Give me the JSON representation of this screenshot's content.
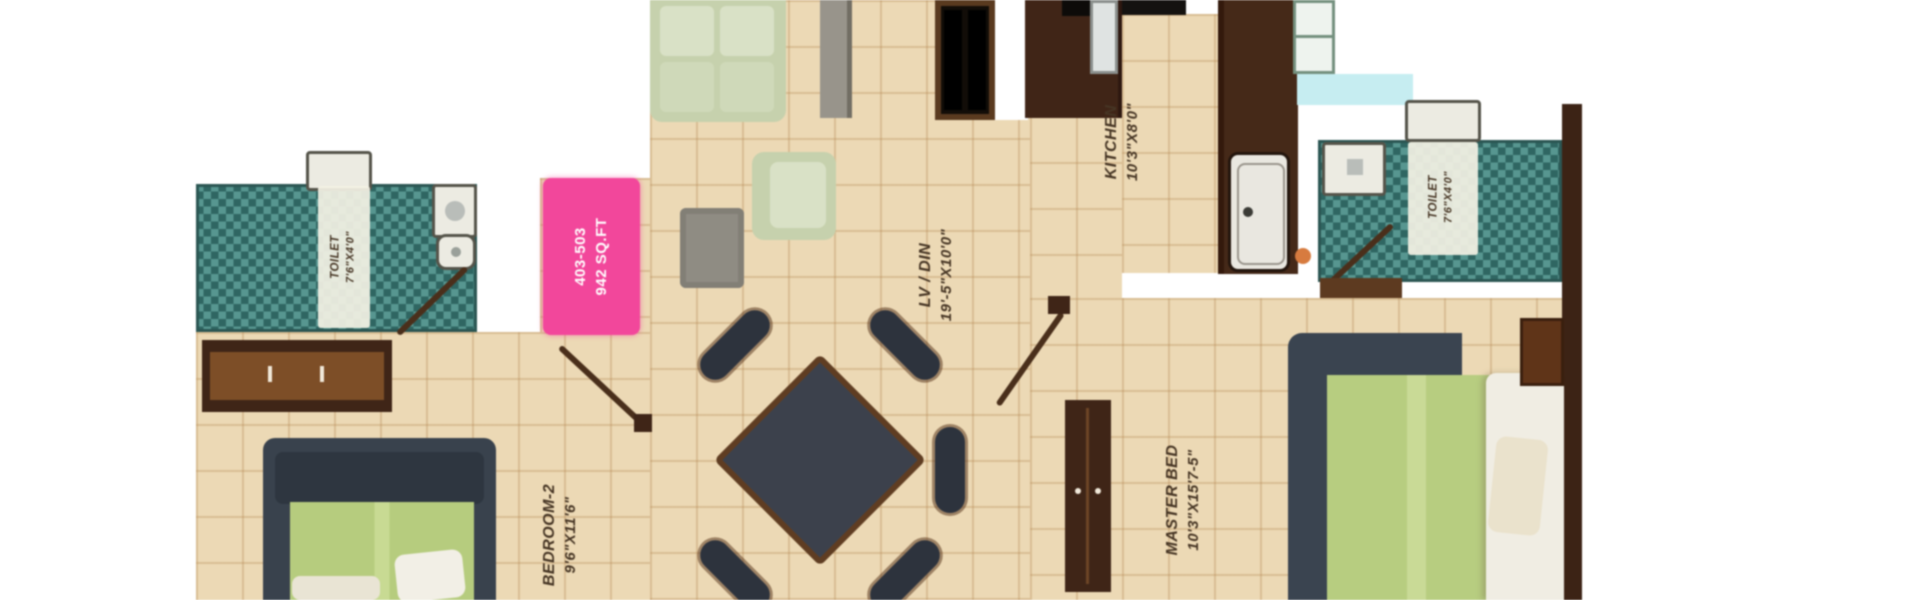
{
  "plan": {
    "type": "apartment-floor-plan",
    "unit_badge": {
      "unit_numbers": "403-503",
      "area": "942 SQ.FT"
    },
    "rooms": {
      "kitchen": {
        "name": "KITCHEN",
        "dims": "10'3\"X8'0\""
      },
      "living_dining": {
        "name": "LV / DIN",
        "dims": "19'-5\"X10'0\""
      },
      "master_bedroom": {
        "name": "MASTER BED",
        "dims": "10'3\"X15'7-5\""
      },
      "bedroom_2": {
        "name": "BEDROOM-2",
        "dims": "9'6\"X11'6\""
      },
      "toilet_left": {
        "name": "TOILET",
        "dims": "7'6\"X4'0\""
      },
      "toilet_right": {
        "name": "TOILET",
        "dims": "7'6\"X4'0\""
      }
    },
    "palette": {
      "floor_tan": "#ecd9b5",
      "bathroom_teal": "#3e7c77",
      "wood_dark": "#3f2517",
      "wood_mid": "#7d4e27",
      "badge_pink": "#f2479b",
      "highlight_cyan": "#c6edf1",
      "bed_green": "#b7cd80",
      "sofa_sage": "#c6d1ad",
      "label_text": "#463524"
    }
  }
}
